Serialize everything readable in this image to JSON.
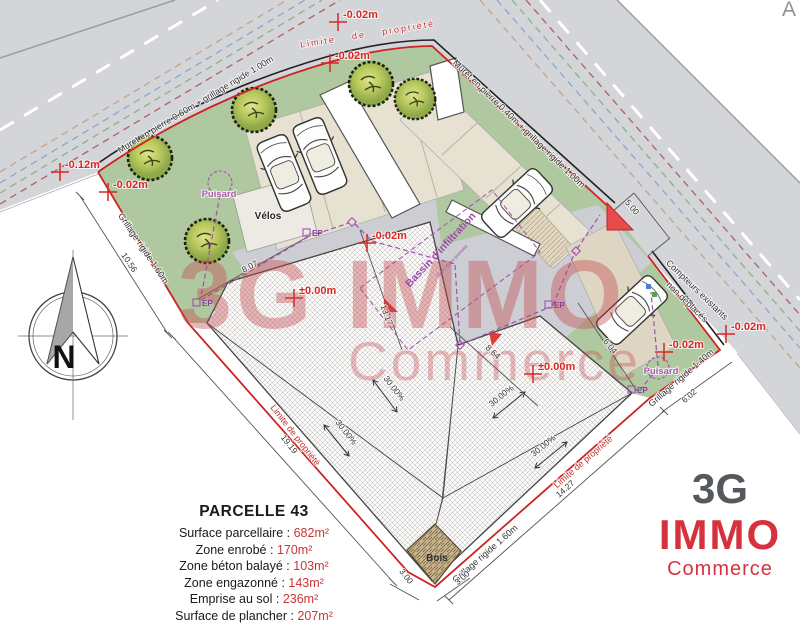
{
  "annotations": {
    "limite_de_propriete": "Limite de propriété",
    "muret_top": "Muret en pierre 0.60m + grillage rigide 1.00m",
    "muret_right": "Muret en pierre 0.40m + grillage rigide 1.00m",
    "compteurs_line1": "Compteurs existants",
    "compteurs_line2": "non déplacés",
    "grillage_160": "Grillage rigide 1.60m",
    "grillage_140": "Grillage rigide 1.40m",
    "velos": "Vélos",
    "puisard": "Puisard",
    "ep": "EP",
    "bassin": "Bassin d'infiltration",
    "bassin_sub": "20m³ - Eaux pluviales",
    "bois": "Bois",
    "corner_letter": "A",
    "north_letter": "N"
  },
  "elevations": [
    {
      "text": "-0.02m"
    },
    {
      "text": "-0.02m"
    },
    {
      "text": "-0.12m"
    },
    {
      "text": "-0.02m"
    },
    {
      "text": "-0.02m"
    },
    {
      "text": "±0.00m"
    },
    {
      "text": "±0.00m"
    },
    {
      "text": "-0.02m"
    },
    {
      "text": "-0.02m"
    }
  ],
  "dimensions": [
    {
      "text": "10.56"
    },
    {
      "text": "19.19"
    },
    {
      "text": "3.00"
    },
    {
      "text": "3.00"
    },
    {
      "text": "14.27"
    },
    {
      "text": "6.02"
    },
    {
      "text": "5.00"
    },
    {
      "text": "8.07"
    },
    {
      "text": "13.17"
    },
    {
      "text": "8.64"
    },
    {
      "text": "6.04"
    }
  ],
  "slopes": [
    {
      "text": "30.00%"
    },
    {
      "text": "30.00%"
    },
    {
      "text": "30.00%"
    },
    {
      "text": "30.00%"
    }
  ],
  "parcel_info": {
    "title": "PARCELLE 43",
    "rows": [
      {
        "label": "Surface parcellaire : ",
        "value": "682m²"
      },
      {
        "label": "Zone enrobé : ",
        "value": "170m²"
      },
      {
        "label": "Zone béton balayé : ",
        "value": "103m²"
      },
      {
        "label": "Zone engazonné : ",
        "value": "143m²"
      },
      {
        "label": "Emprise au sol : ",
        "value": "236m²"
      },
      {
        "label": "Surface de plancher : ",
        "value": "207m²"
      }
    ]
  },
  "watermark": {
    "line1": "3G IMMO",
    "line2": "Commerce"
  },
  "logo": {
    "top": "3G",
    "name": "IMMO",
    "sub": "Commerce"
  },
  "colors": {
    "property_line": "#cc2222",
    "annotation_red": "#d82626",
    "utility_purple": "#a050b0",
    "lawn_green": "#afc8a0",
    "road_gray": "#d3d5d9"
  }
}
